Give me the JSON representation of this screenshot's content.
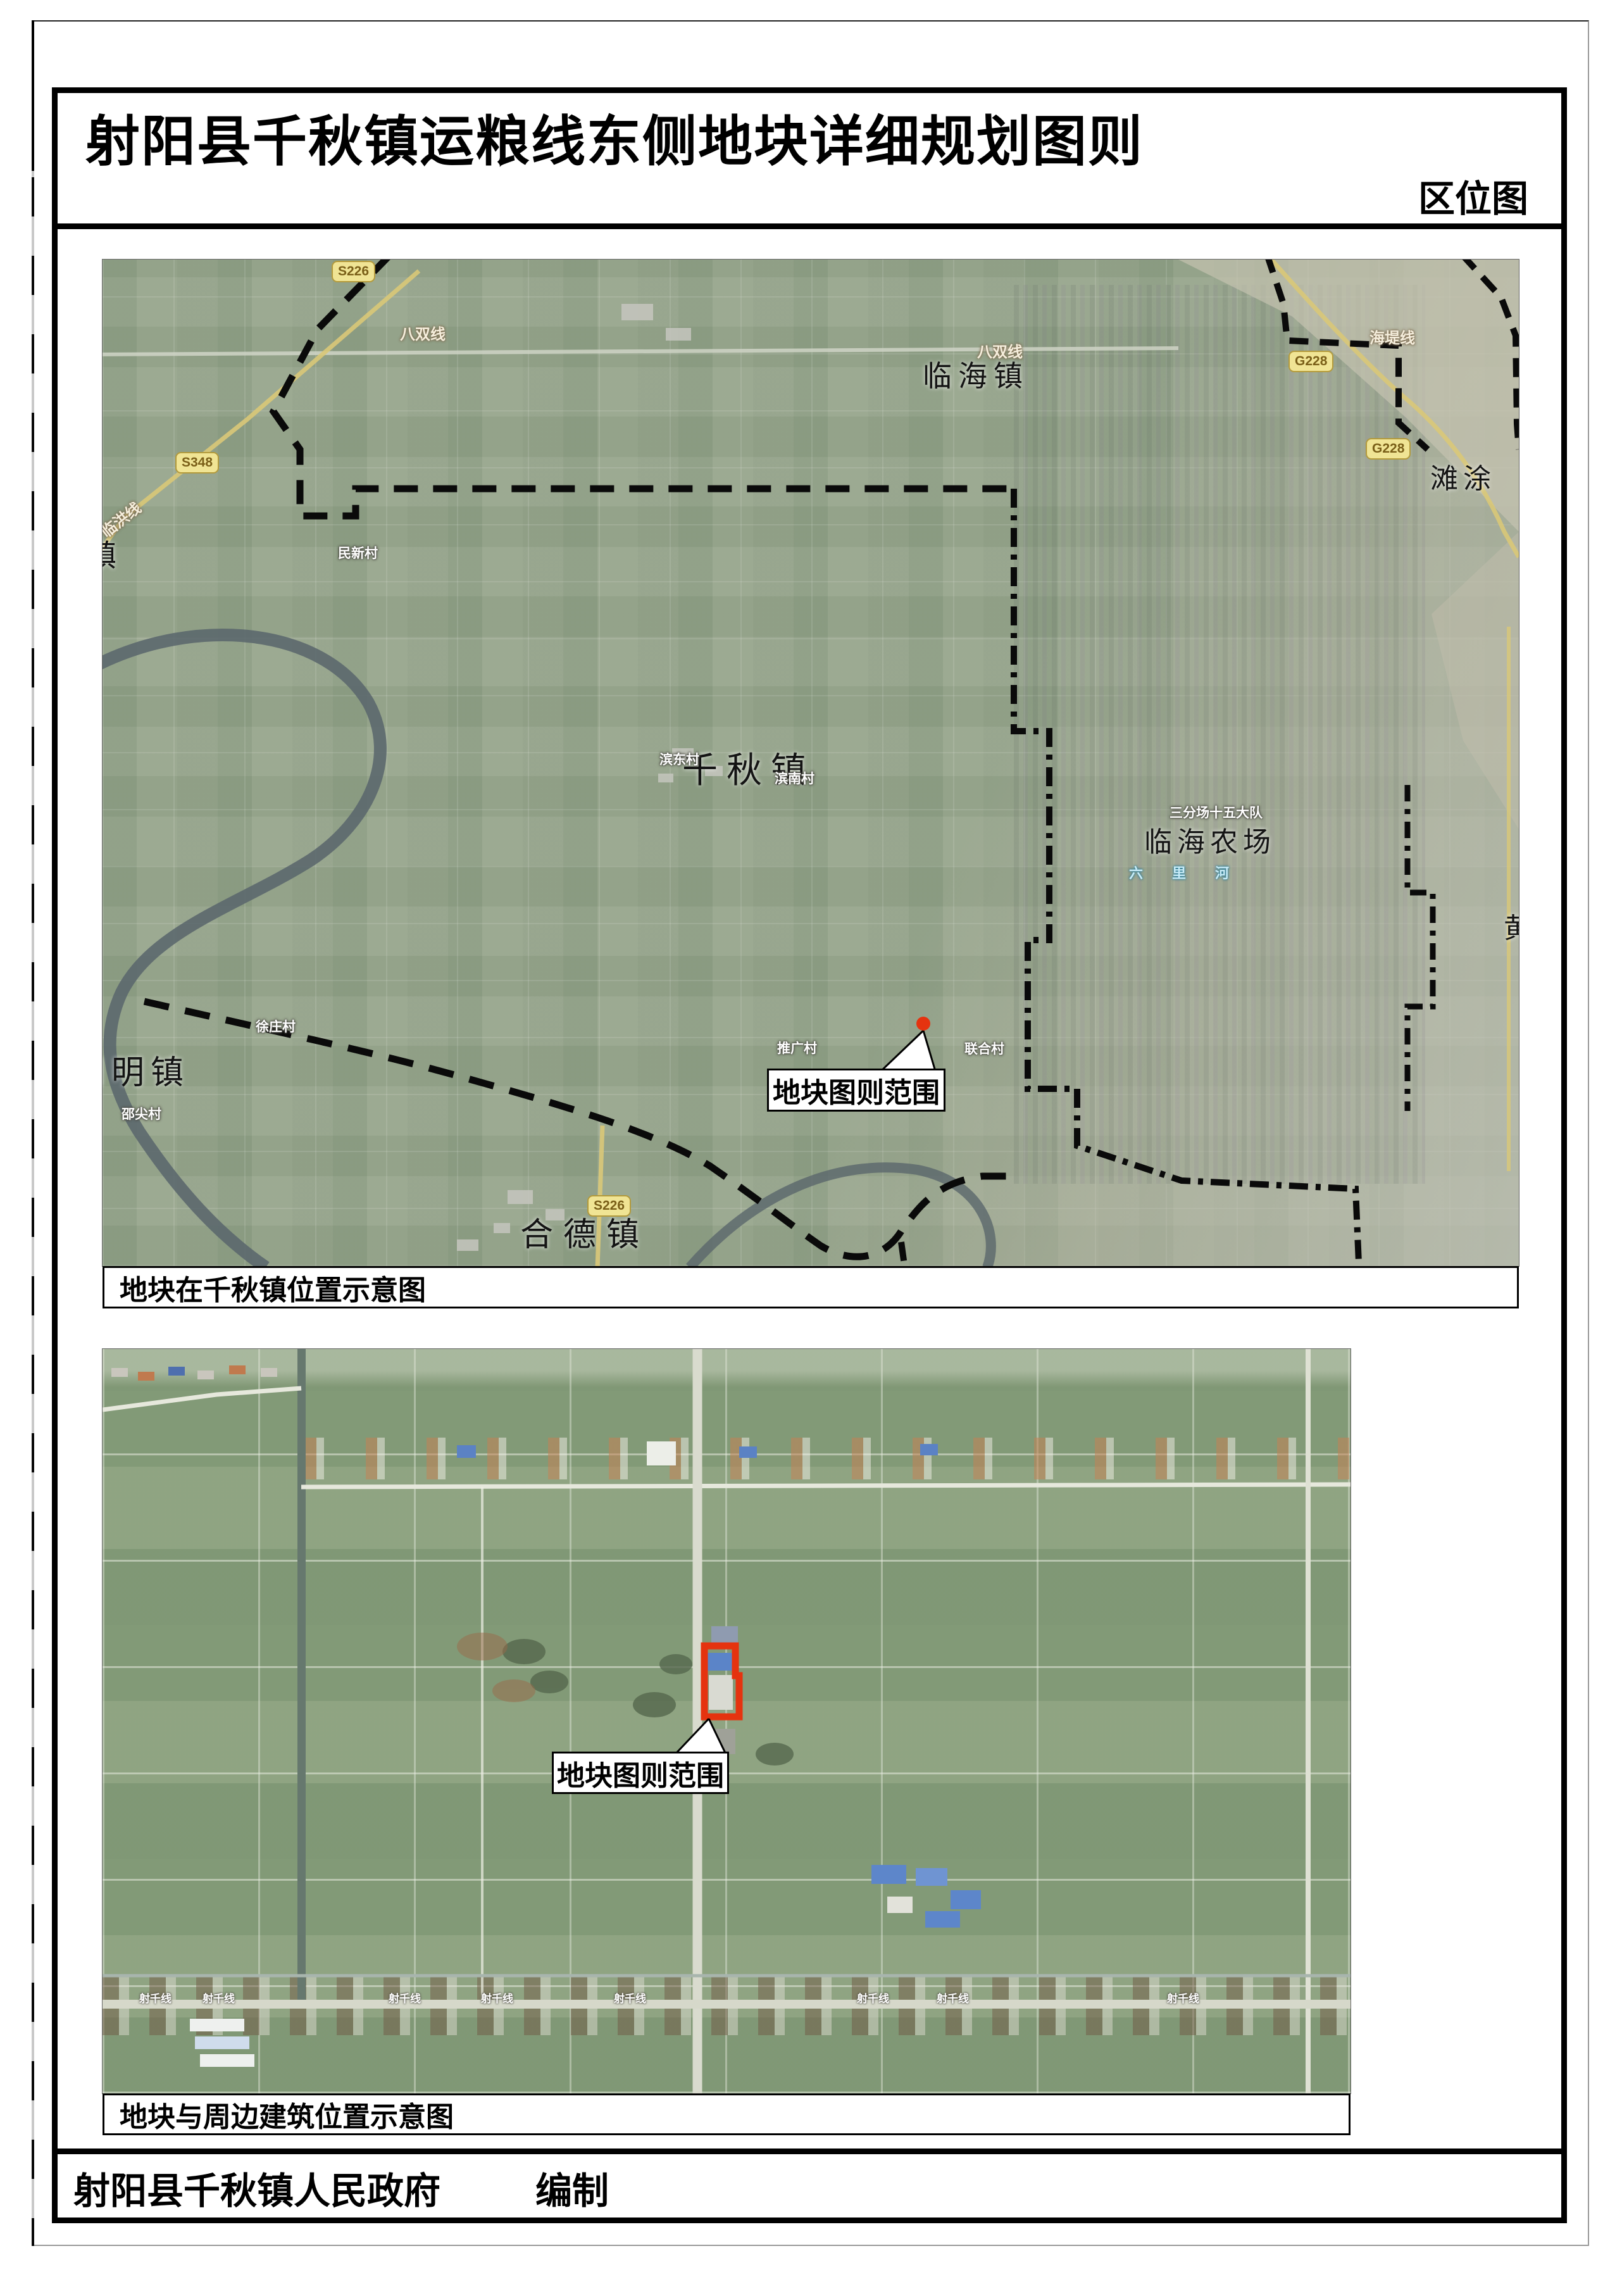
{
  "page": {
    "title": "射阳县千秋镇运粮线东侧地块详细规划图则",
    "corner_label": "区位图",
    "footer_org": "射阳县千秋镇人民政府",
    "footer_label": "编制"
  },
  "colors": {
    "accent_red": "#e5330f",
    "boundary_black": "#000000",
    "map1_green": "#9aa892",
    "map2_green": "#8aa07e",
    "road_badge_yellow": "#f0e494"
  },
  "map1": {
    "caption": "地块在千秋镇位置示意图",
    "callout_label": "地块图则范围",
    "town_labels": [
      {
        "text": "临海镇"
      },
      {
        "text": "千秋镇"
      },
      {
        "text": "临海农场"
      },
      {
        "text": "合德镇"
      },
      {
        "text": "阳明镇"
      },
      {
        "text": "滩涂"
      },
      {
        "text": "黄"
      },
      {
        "text": "镇"
      }
    ],
    "village_labels": [
      {
        "text": "民新村"
      },
      {
        "text": "徐庄村"
      },
      {
        "text": "邵尖村"
      },
      {
        "text": "推广村"
      },
      {
        "text": "联合村"
      },
      {
        "text": "滨南村"
      },
      {
        "text": "滨东村"
      },
      {
        "text": "三分场十五大队"
      }
    ],
    "road_labels": [
      {
        "text": "八双线"
      },
      {
        "text": "八双线"
      },
      {
        "text": "海堤线"
      },
      {
        "text": "临洪线"
      }
    ],
    "water_labels": [
      {
        "text": "六里河"
      }
    ],
    "badges": [
      {
        "code": "S226"
      },
      {
        "code": "G228"
      },
      {
        "code": "G228"
      },
      {
        "code": "S348"
      },
      {
        "code": "S226"
      }
    ]
  },
  "map2": {
    "caption": "地块与周边建筑位置示意图",
    "callout_label": "地块图则范围",
    "road_name": "射千线"
  }
}
